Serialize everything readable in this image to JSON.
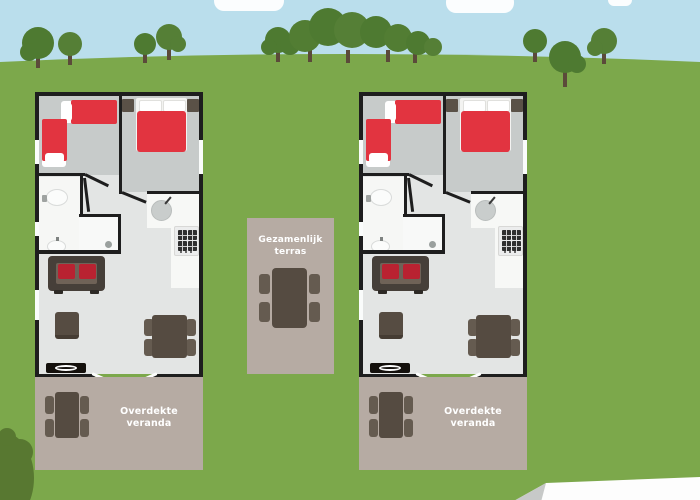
{
  "labels": {
    "terrace_line1": "Gezamenlijk",
    "terrace_line2": "terras",
    "veranda": "Overdekte veranda"
  },
  "colors": {
    "sky": "#badeec",
    "cloud": "#fbfdfe",
    "grass": "#7ca84b",
    "tree_crown": "#4e7a31",
    "tree_trunk": "#5b4a3a",
    "bush": "#587831",
    "road": "#fdfdfd",
    "wall": "#1e1e1e",
    "bedroom_floor": "#c7cbca",
    "living_floor": "#e3e5e4",
    "wet_room_floor": "#f6f7f5",
    "bed_red": "#e23440",
    "cushion_red": "#b92231",
    "furniture_brown": "#554b41",
    "terrace_taupe": "#b6aba3",
    "label_text": "#ffffff"
  }
}
